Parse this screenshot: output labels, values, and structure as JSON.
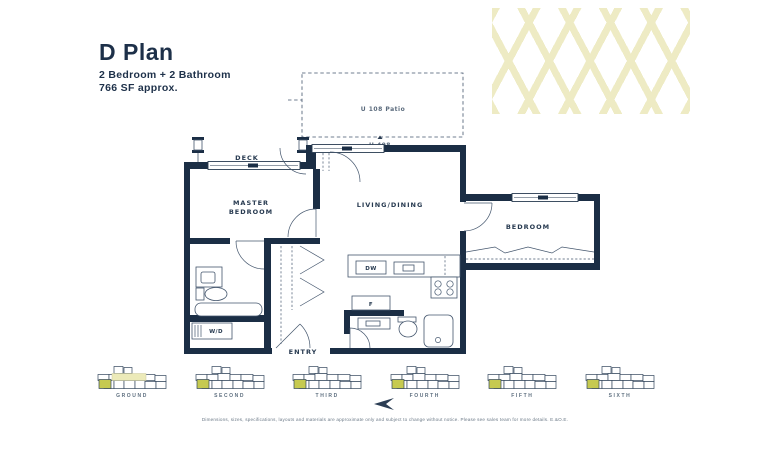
{
  "header": {
    "title": "D Plan",
    "subtitle": "2 Bedroom + 2 Bathroom",
    "area": "766 SF approx."
  },
  "plan": {
    "patio_label": "U 108 Patio",
    "unit_marker": "U 408",
    "rooms": {
      "deck": "DECK",
      "master_line1": "MASTER",
      "master_line2": "BEDROOM",
      "living_dining": "LIVING/DINING",
      "bedroom": "BEDROOM",
      "entry": "ENTRY"
    },
    "fixtures": {
      "dishwasher": "DW",
      "fridge": "F",
      "washer_dryer": "W/D"
    }
  },
  "keyplans": {
    "floors": [
      {
        "label": "GROUND"
      },
      {
        "label": "SECOND"
      },
      {
        "label": "THIRD"
      },
      {
        "label": "FOURTH"
      },
      {
        "label": "FIFTH"
      },
      {
        "label": "SIXTH"
      }
    ]
  },
  "footer": {
    "disclaimer": "Dimensions, sizes, specifications, layouts and materials are approximate only and subject to change without notice. Please see sales team for more details. E.&O.E."
  },
  "colors": {
    "wall": "#1b2e45",
    "thin_line": "#44566d",
    "highlight_unit": "#c6ca50",
    "lattice": "#eeebc4",
    "amenity": "#eceab9"
  }
}
